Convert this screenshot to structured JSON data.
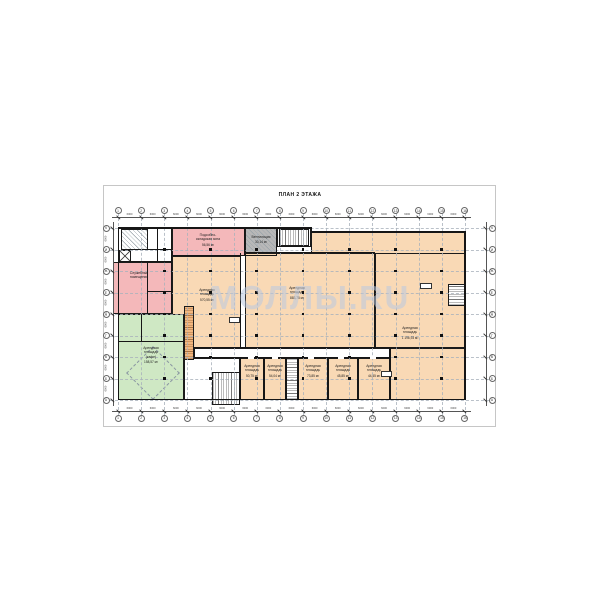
{
  "page": {
    "title": "ПЛАН 2 ЭТАЖА",
    "watermark": "МОЛЛЫ.RU"
  },
  "rooms": {
    "storage": {
      "label": "Подсобно-\nскладская зона",
      "area": "56,56 м²"
    },
    "vent": {
      "label": "Вентиляция",
      "area": "30,14 м²"
    },
    "service": {
      "label": "Служебные\nпомещения",
      "area": ""
    },
    "cafe": {
      "label": "Арендная\nплощадь\n(кафе)",
      "area": "158,57 м²"
    },
    "rent_left": {
      "label": "Арендная\nплощадь",
      "area": "570,55 м²"
    },
    "rent_center": {
      "label": "Арендная\nплощадь",
      "area": "883,75 м²"
    },
    "rent_right": {
      "label": "Арендная\nплощадь",
      "area": "1 196,93 м²"
    },
    "unit1": {
      "label": "Арендная\nплощадь",
      "area": "50,75 м²"
    },
    "unit2": {
      "label": "Арендная\nплощадь",
      "area": "54,04 м²"
    },
    "unit3": {
      "label": "Арендная\nплощадь",
      "area": "73,85 м²"
    },
    "unit4": {
      "label": "Арендная\nплощадь",
      "area": "45,85 м²"
    },
    "unit5": {
      "label": "Арендная\nплощадь",
      "area": "44,45 м²"
    }
  },
  "grid": {
    "col_labels": [
      "1",
      "2",
      "3",
      "4",
      "5",
      "6",
      "7",
      "8",
      "9",
      "10",
      "11",
      "12",
      "13",
      "14",
      "15",
      "16"
    ],
    "row_labels": [
      "К",
      "И",
      "Ж",
      "Е",
      "Д",
      "Г",
      "В",
      "Б",
      "А"
    ],
    "dim_label": "6000"
  },
  "colors": {
    "rent": "#f9d9b5",
    "service": "#f4b8ba",
    "cafe": "#cfe8c4",
    "vent": "#b8b8b8"
  }
}
